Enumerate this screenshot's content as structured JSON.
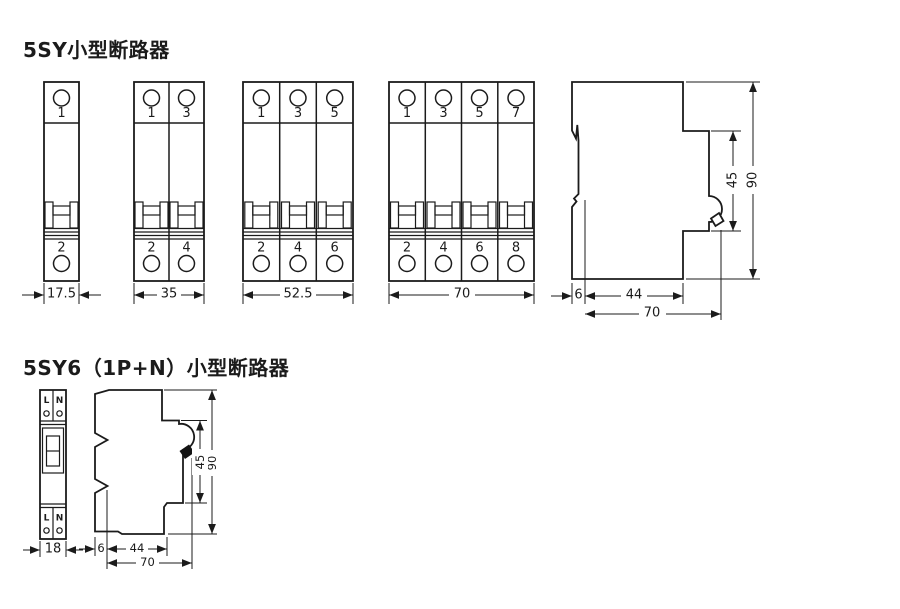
{
  "s1": {
    "title": "5SY小型断路器",
    "breakers": [
      {
        "name": "1-pole",
        "top": [
          "1"
        ],
        "bottom": [
          "2"
        ],
        "width": "17.5"
      },
      {
        "name": "2-pole",
        "top": [
          "1",
          "3"
        ],
        "bottom": [
          "2",
          "4"
        ],
        "width": "35"
      },
      {
        "name": "3-pole",
        "top": [
          "1",
          "3",
          "5"
        ],
        "bottom": [
          "2",
          "4",
          "6"
        ],
        "width": "52.5"
      },
      {
        "name": "4-pole",
        "top": [
          "1",
          "3",
          "5",
          "7"
        ],
        "bottom": [
          "2",
          "4",
          "6",
          "8"
        ],
        "width": "70"
      }
    ],
    "side": {
      "height": "90",
      "handle_height": "45",
      "rail": "6",
      "body_depth": "44",
      "total_depth": "70"
    }
  },
  "s2": {
    "title": "5SY6（1P+N）小型断路器",
    "front": {
      "top": [
        "L",
        "N"
      ],
      "bottom": [
        "L",
        "N"
      ],
      "width": "18"
    },
    "side": {
      "height": "90",
      "handle_height": "45",
      "rail": "6",
      "body_depth": "44",
      "total_depth": "70"
    }
  }
}
